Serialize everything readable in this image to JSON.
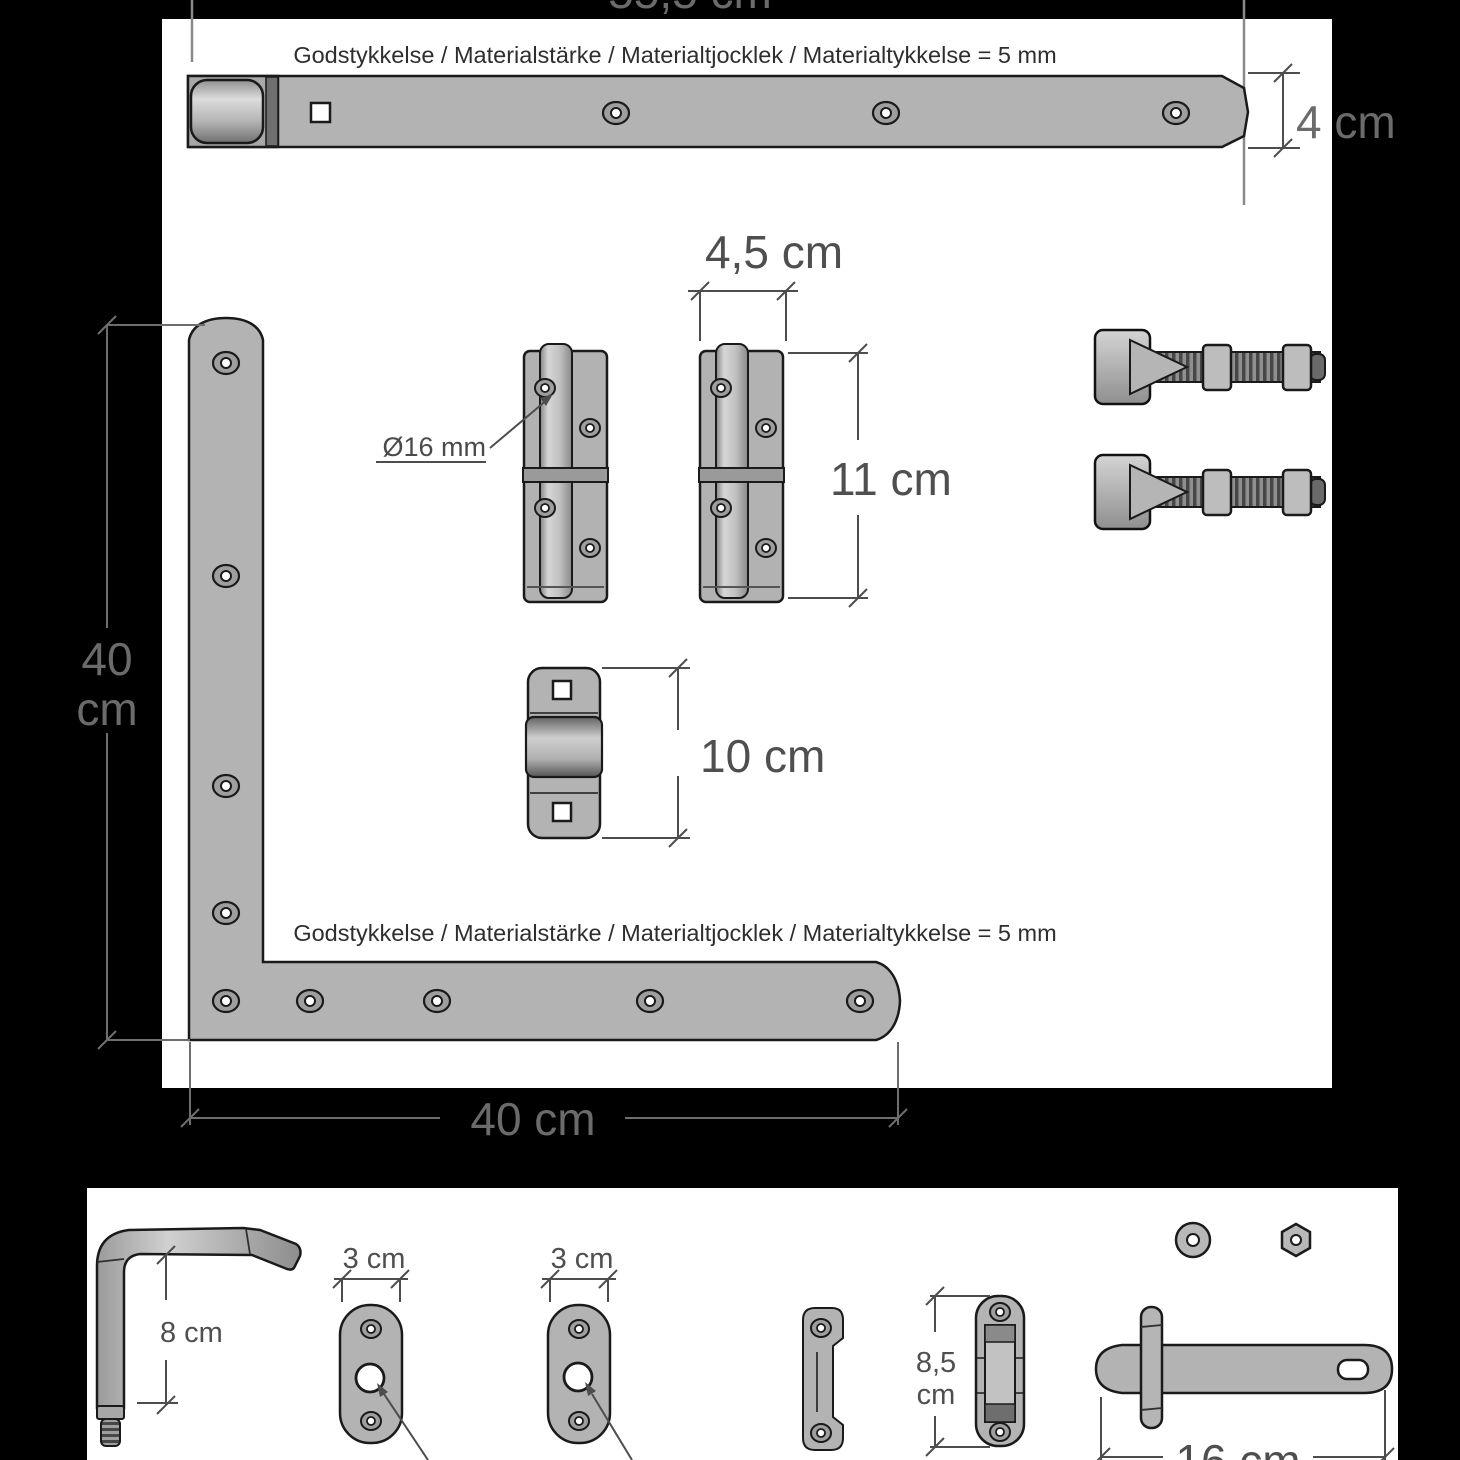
{
  "colors": {
    "background": "#000000",
    "panel": "#ffffff",
    "part_fill": "#b3b3b3",
    "outline": "#1a1a1a",
    "dimension": "#4d4d4d"
  },
  "top_panel": {
    "thickness_note": "Godstykkelse / Materialstärke / Materialtjocklek / Materialtykkelse = 5 mm",
    "dims": {
      "strap_length": "55,5 cm",
      "strap_width": "4 cm",
      "hinge_plate_width": "4,5 cm",
      "hinge_plate_height": "11 cm",
      "pin_diameter": "Ø16 mm",
      "keeper_height": "10 cm",
      "corner_vertical": [
        "40",
        "cm"
      ],
      "corner_horizontal": "40 cm"
    }
  },
  "bottom_panel": {
    "dims": {
      "pin_length": "8 cm",
      "plate_width_1": "3 cm",
      "plate_width_2": "3 cm",
      "slide_height": [
        "8,5",
        "cm"
      ],
      "latch_length": "16 cm"
    }
  }
}
